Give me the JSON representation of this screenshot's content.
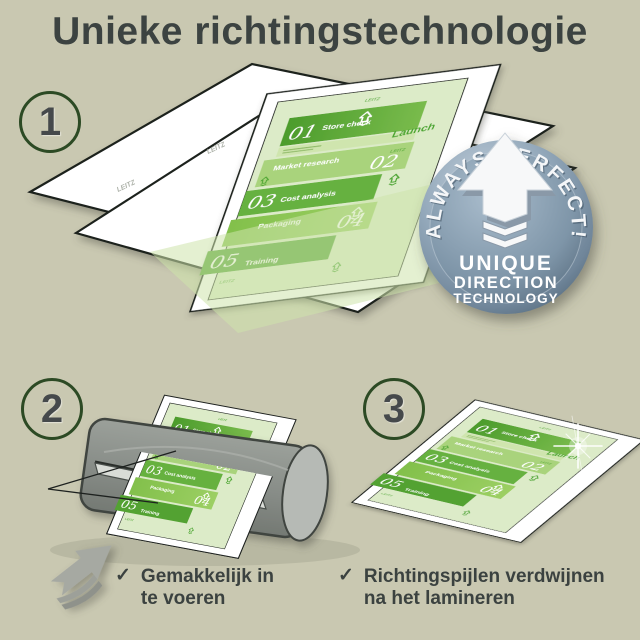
{
  "title": "Unieke richtingstechnologie",
  "steps": [
    {
      "number": "1"
    },
    {
      "number": "2"
    },
    {
      "number": "3"
    }
  ],
  "document": {
    "items": [
      {
        "num": "01",
        "label": "Store check"
      },
      {
        "num": "02",
        "label": "Market research"
      },
      {
        "num": "03",
        "label": "Cost analysis"
      },
      {
        "num": "04",
        "label": "Packaging"
      },
      {
        "num": "05",
        "label": "Training"
      }
    ],
    "launch_label": "Launch",
    "watermark": "LEITZ"
  },
  "badge": {
    "arc_text": "ALWAYS PERFECT!",
    "line1": "UNIQUE",
    "line2": "DIRECTION",
    "line3": "TECHNOLOGY"
  },
  "captions": [
    {
      "check": "✓",
      "line1": "Gemakkelijk in",
      "line2": "te voeren"
    },
    {
      "check": "✓",
      "line1": "Richtingspijlen verdwijnen",
      "line2": "na het lamineren"
    }
  ],
  "colors": {
    "background": "#c9c8b1",
    "title_text": "#3c4341",
    "circle_ring": "#2c4a24",
    "doc_background": "#dcebc8",
    "green_dark": "#53a232",
    "green_mid": "#8cc553",
    "green_light": "#a9d37b",
    "badge_blue_gray": "#8ba1b3",
    "machine_gray": "#8e938f",
    "arrow_gray": "#a6a9a2"
  }
}
